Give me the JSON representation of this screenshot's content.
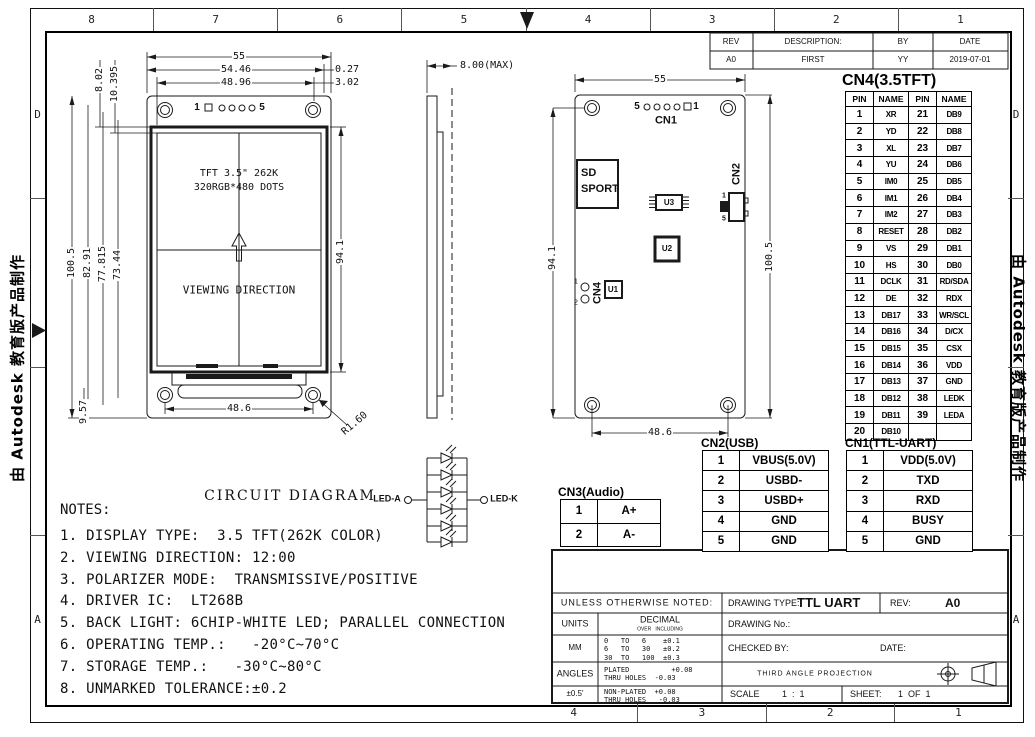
{
  "border": {
    "top_zones": [
      "8",
      "7",
      "6",
      "5",
      "4",
      "3",
      "2",
      "1"
    ],
    "bottom_zones": [
      "4",
      "3",
      "2",
      "1"
    ],
    "left_zones": [
      "D",
      "",
      "",
      "A"
    ],
    "right_zones": [
      "D",
      "",
      "",
      "A"
    ],
    "watermark": "由 Autodesk 教育版产品制作"
  },
  "rev_table": {
    "headers": [
      "REV",
      "DESCRIPTION:",
      "BY",
      "DATE"
    ],
    "rows": [
      [
        "A0",
        "FIRST",
        "YY",
        "2019-07-01"
      ]
    ]
  },
  "front_view": {
    "pin_left": "1",
    "pin_right": "5",
    "display_line1": "TFT 3.5\" 262K",
    "display_line2": "320RGB*480 DOTS",
    "viewing_direction": "VIEWING DIRECTION",
    "dims": {
      "overall_width": "55",
      "width_2": "54.46",
      "offset_1": "0.27",
      "active_width": "48.96",
      "offset_2": "3.02",
      "top_margin_1": "8.02",
      "top_margin_2": "10.395",
      "overall_height": "100.5",
      "height_2": "82.91",
      "height_3": "77.815",
      "height_4": "73.44",
      "bottom_margin": "9.57",
      "right_height": "94.1",
      "hole_span": "48.6",
      "radius": "R1.60"
    }
  },
  "side_view": {
    "thickness": "8.00(MAX)"
  },
  "back_view": {
    "pin_left": "5",
    "pin_right": "1",
    "cn1_label": "CN1",
    "cn2_label": "CN2",
    "cn4_label": "CN4",
    "cn4_pin1": "1",
    "cn4_pin2": "2",
    "cn2_pin1": "1",
    "cn2_pin5": "5",
    "sd_line1": "SD",
    "sd_line2": "SPORT",
    "u1": "U1",
    "u2": "U2",
    "u3": "U3",
    "dims": {
      "width": "55",
      "height_right": "100.5",
      "height_left": "94.1",
      "hole_span": "48.6"
    }
  },
  "cn4_table": {
    "title": "CN4(3.5TFT)",
    "headers": [
      "PIN",
      "NAME",
      "PIN",
      "NAME"
    ],
    "rows": [
      [
        "1",
        "XR",
        "21",
        "DB9"
      ],
      [
        "2",
        "YD",
        "22",
        "DB8"
      ],
      [
        "3",
        "XL",
        "23",
        "DB7"
      ],
      [
        "4",
        "YU",
        "24",
        "DB6"
      ],
      [
        "5",
        "IM0",
        "25",
        "DB5"
      ],
      [
        "6",
        "IM1",
        "26",
        "DB4"
      ],
      [
        "7",
        "IM2",
        "27",
        "DB3"
      ],
      [
        "8",
        "RESET",
        "28",
        "DB2"
      ],
      [
        "9",
        "VS",
        "29",
        "DB1"
      ],
      [
        "10",
        "HS",
        "30",
        "DB0"
      ],
      [
        "11",
        "DCLK",
        "31",
        "RD/SDA"
      ],
      [
        "12",
        "DE",
        "32",
        "RDX"
      ],
      [
        "13",
        "DB17",
        "33",
        "WR/SCL"
      ],
      [
        "14",
        "DB16",
        "34",
        "D/CX"
      ],
      [
        "15",
        "DB15",
        "35",
        "CSX"
      ],
      [
        "16",
        "DB14",
        "36",
        "VDD"
      ],
      [
        "17",
        "DB13",
        "37",
        "GND"
      ],
      [
        "18",
        "DB12",
        "38",
        "LEDK"
      ],
      [
        "19",
        "DB11",
        "39",
        "LEDA"
      ],
      [
        "20",
        "DB10",
        "",
        ""
      ]
    ]
  },
  "cn3_table": {
    "title": "CN3(Audio)",
    "rows": [
      [
        "1",
        "A+"
      ],
      [
        "2",
        "A-"
      ]
    ]
  },
  "cn2_table": {
    "title": "CN2(USB)",
    "rows": [
      [
        "1",
        "VBUS(5.0V)"
      ],
      [
        "2",
        "USBD-"
      ],
      [
        "3",
        "USBD+"
      ],
      [
        "4",
        "GND"
      ],
      [
        "5",
        "GND"
      ]
    ]
  },
  "cn1_table": {
    "title": "CN1(TTL-UART)",
    "rows": [
      [
        "1",
        "VDD(5.0V)"
      ],
      [
        "2",
        "TXD"
      ],
      [
        "3",
        "RXD"
      ],
      [
        "4",
        "BUSY"
      ],
      [
        "5",
        "GND"
      ]
    ]
  },
  "circuit": {
    "title": "CIRCUIT DIAGRAM",
    "anode": "LED-A",
    "cathode": "LED-K"
  },
  "notes": {
    "title": "NOTES:",
    "items": [
      "1. DISPLAY TYPE:  3.5 TFT(262K COLOR)",
      "2. VIEWING DIRECTION: 12:00",
      "3. POLARIZER MODE:  TRANSMISSIVE/POSITIVE",
      "4. DRIVER IC:  LT268B",
      "5. BACK LIGHT: 6CHIP-WHITE LED; PARALLEL CONNECTION",
      "6. OPERATING TEMP.:   -20°C~70°C",
      "7. STORAGE TEMP.:   -30°C~80°C",
      "8. UNMARKED TOLERANCE:±0.2"
    ]
  },
  "title_block": {
    "unless": "UNLESS OTHERWISE NOTED:",
    "drawing_type_label": "DRAWING TYPE:",
    "drawing_type": "TTL UART",
    "rev_label": "REV:",
    "rev": "A0",
    "units_label": "UNITS",
    "decimal_label": "DECIMAL",
    "decimal_sub": "OVER   INCLUDING",
    "drawing_no_label": "DRAWING No.:",
    "units_value": "MM",
    "tolerances": [
      "0   TO   6    ±0.1",
      "6   TO   30   ±0.2",
      "30  TO   100  ±0.3"
    ],
    "checked_by_label": "CHECKED BY:",
    "date_label": "DATE:",
    "angles_label": "ANGLES",
    "angle_tol": "±0.5'",
    "plated_lines": [
      "PLATED          +0.08",
      "THRU HOLES  -0.03"
    ],
    "nonplated_lines": [
      "NON-PLATED  +0.08",
      "THRU HOLES   -0.03"
    ],
    "projection": "THIRD ANGLE PROJECTION",
    "scale_label": "SCALE",
    "scale_value": "1  :  1",
    "sheet_label": "SHEET:",
    "sheet_value": "1  OF  1"
  }
}
